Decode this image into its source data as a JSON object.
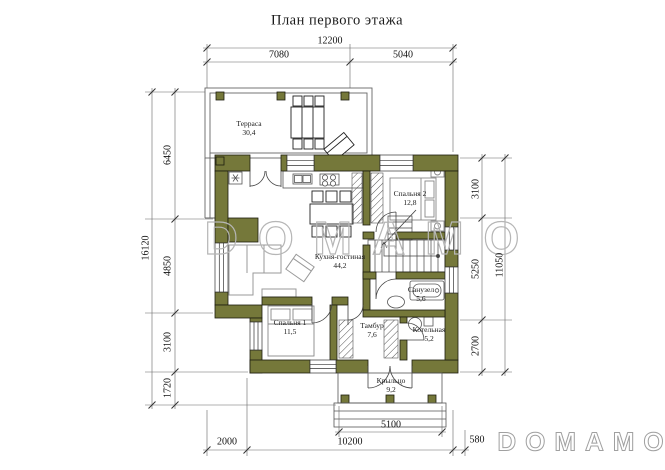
{
  "title": "План первого этажа",
  "watermark": {
    "center": "DOMAMO",
    "corner": "DOMAMO"
  },
  "rooms": {
    "terrace": {
      "name": "Терраса",
      "area": "30,4"
    },
    "bedroom2": {
      "name": "Спальня 2",
      "area": "12,8"
    },
    "living": {
      "name": "Кухня-гостиная",
      "area": "44,2"
    },
    "bedroom1": {
      "name": "Спальня 1",
      "area": "11,5"
    },
    "vestibule": {
      "name": "Тамбур",
      "area": "7,6"
    },
    "bathroom": {
      "name": "Санузел",
      "area": "5,6"
    },
    "boiler": {
      "name": "Котельная",
      "area": "5,2"
    },
    "porch": {
      "name": "Крыльцо",
      "area": "9,2"
    }
  },
  "dimensions": {
    "top_total": "12200",
    "top_left": "7080",
    "top_right": "5040",
    "left_total": "16120",
    "left_seg1": "6450",
    "left_seg2": "4850",
    "left_seg3": "3100",
    "left_seg4": "1720",
    "right_seg1": "3100",
    "right_seg2": "5250",
    "right_seg3": "2700",
    "right_total": "11050",
    "porch_width": "5100",
    "bottom_left": "2000",
    "bottom_mid": "10200",
    "bottom_right": "580"
  },
  "colors": {
    "wall": "#75783a",
    "dimension_line": "#666666",
    "watermark": "#b6b6b6"
  }
}
